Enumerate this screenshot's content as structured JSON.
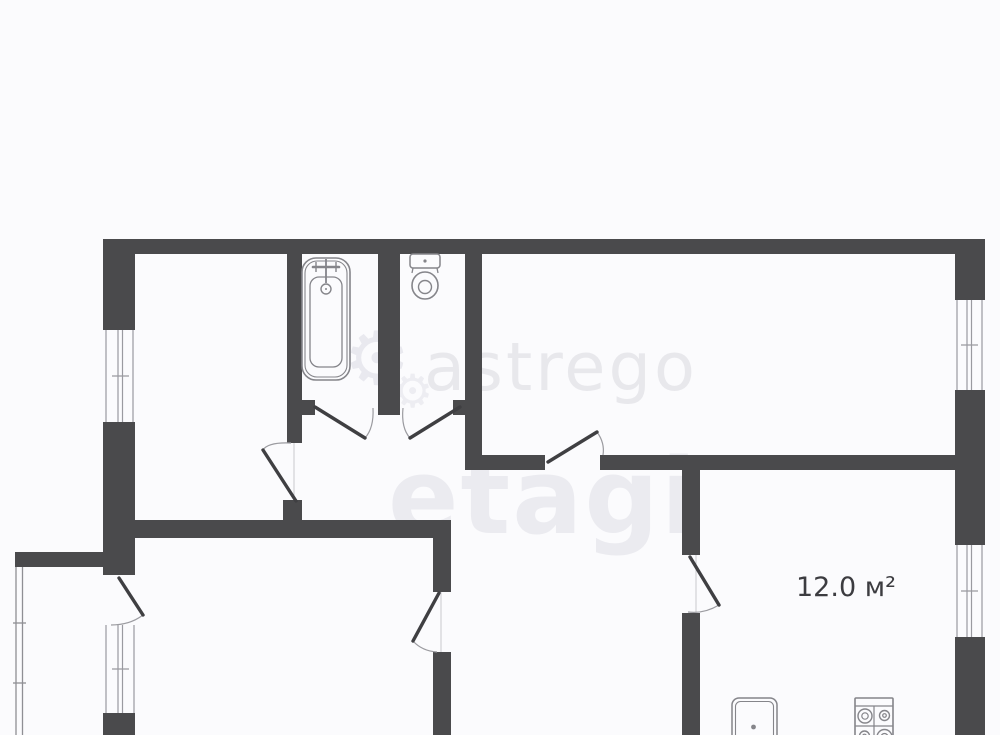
{
  "title": "Apartment floor plan",
  "rooms": {
    "kitchen": {
      "area_label": "12.0 м²"
    }
  },
  "watermarks": {
    "logo_text_1": "astrego",
    "logo_text_2": "etagi",
    "gear_glyph": "⚙"
  },
  "colors": {
    "wall": "#4a4a4c",
    "background": "#fbfbfd",
    "fixture_line": "#85858a",
    "door_leaf": "#3f3f42",
    "door_arc": "#9b9ba0",
    "watermark": "#e9e9ee",
    "label_text": "#3c3c40"
  },
  "icons": [
    "bathtub-icon",
    "toilet-icon",
    "kitchen-sink-icon",
    "stove-icon",
    "gear-icon",
    "window-icon",
    "door-swing-icon"
  ]
}
